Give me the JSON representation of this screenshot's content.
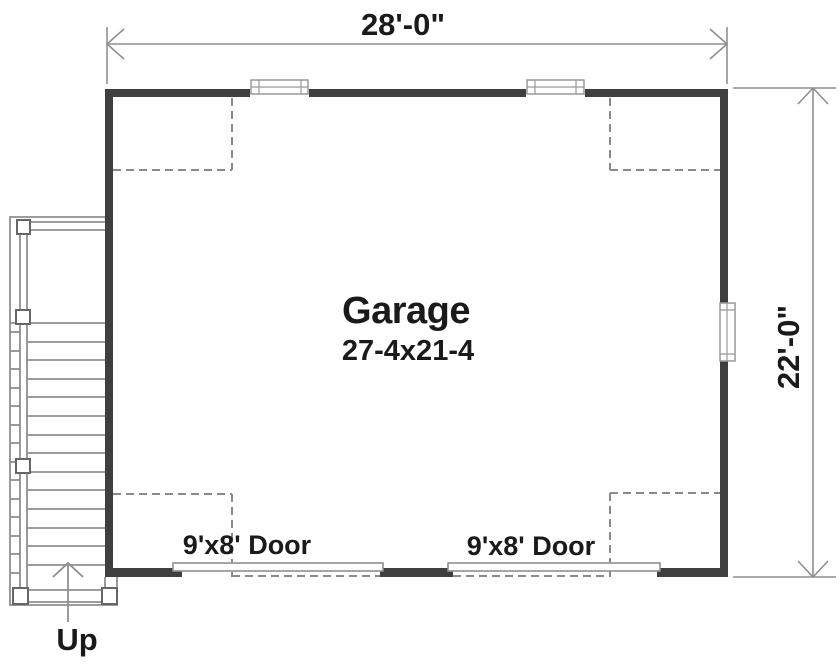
{
  "colors": {
    "wall": "#3f3f3f",
    "line": "#8f8f8f",
    "dashed_line": "#8a8a8a",
    "text": "#1a1a1a",
    "background": "#ffffff"
  },
  "dimensions": {
    "top": "28'-0\"",
    "right": "22'-0\""
  },
  "room": {
    "name": "Garage",
    "size": "27-4x21-4"
  },
  "doors": [
    {
      "label": "9'x8' Door"
    },
    {
      "label": "9'x8' Door"
    }
  ],
  "stairs": {
    "direction_label": "Up"
  }
}
